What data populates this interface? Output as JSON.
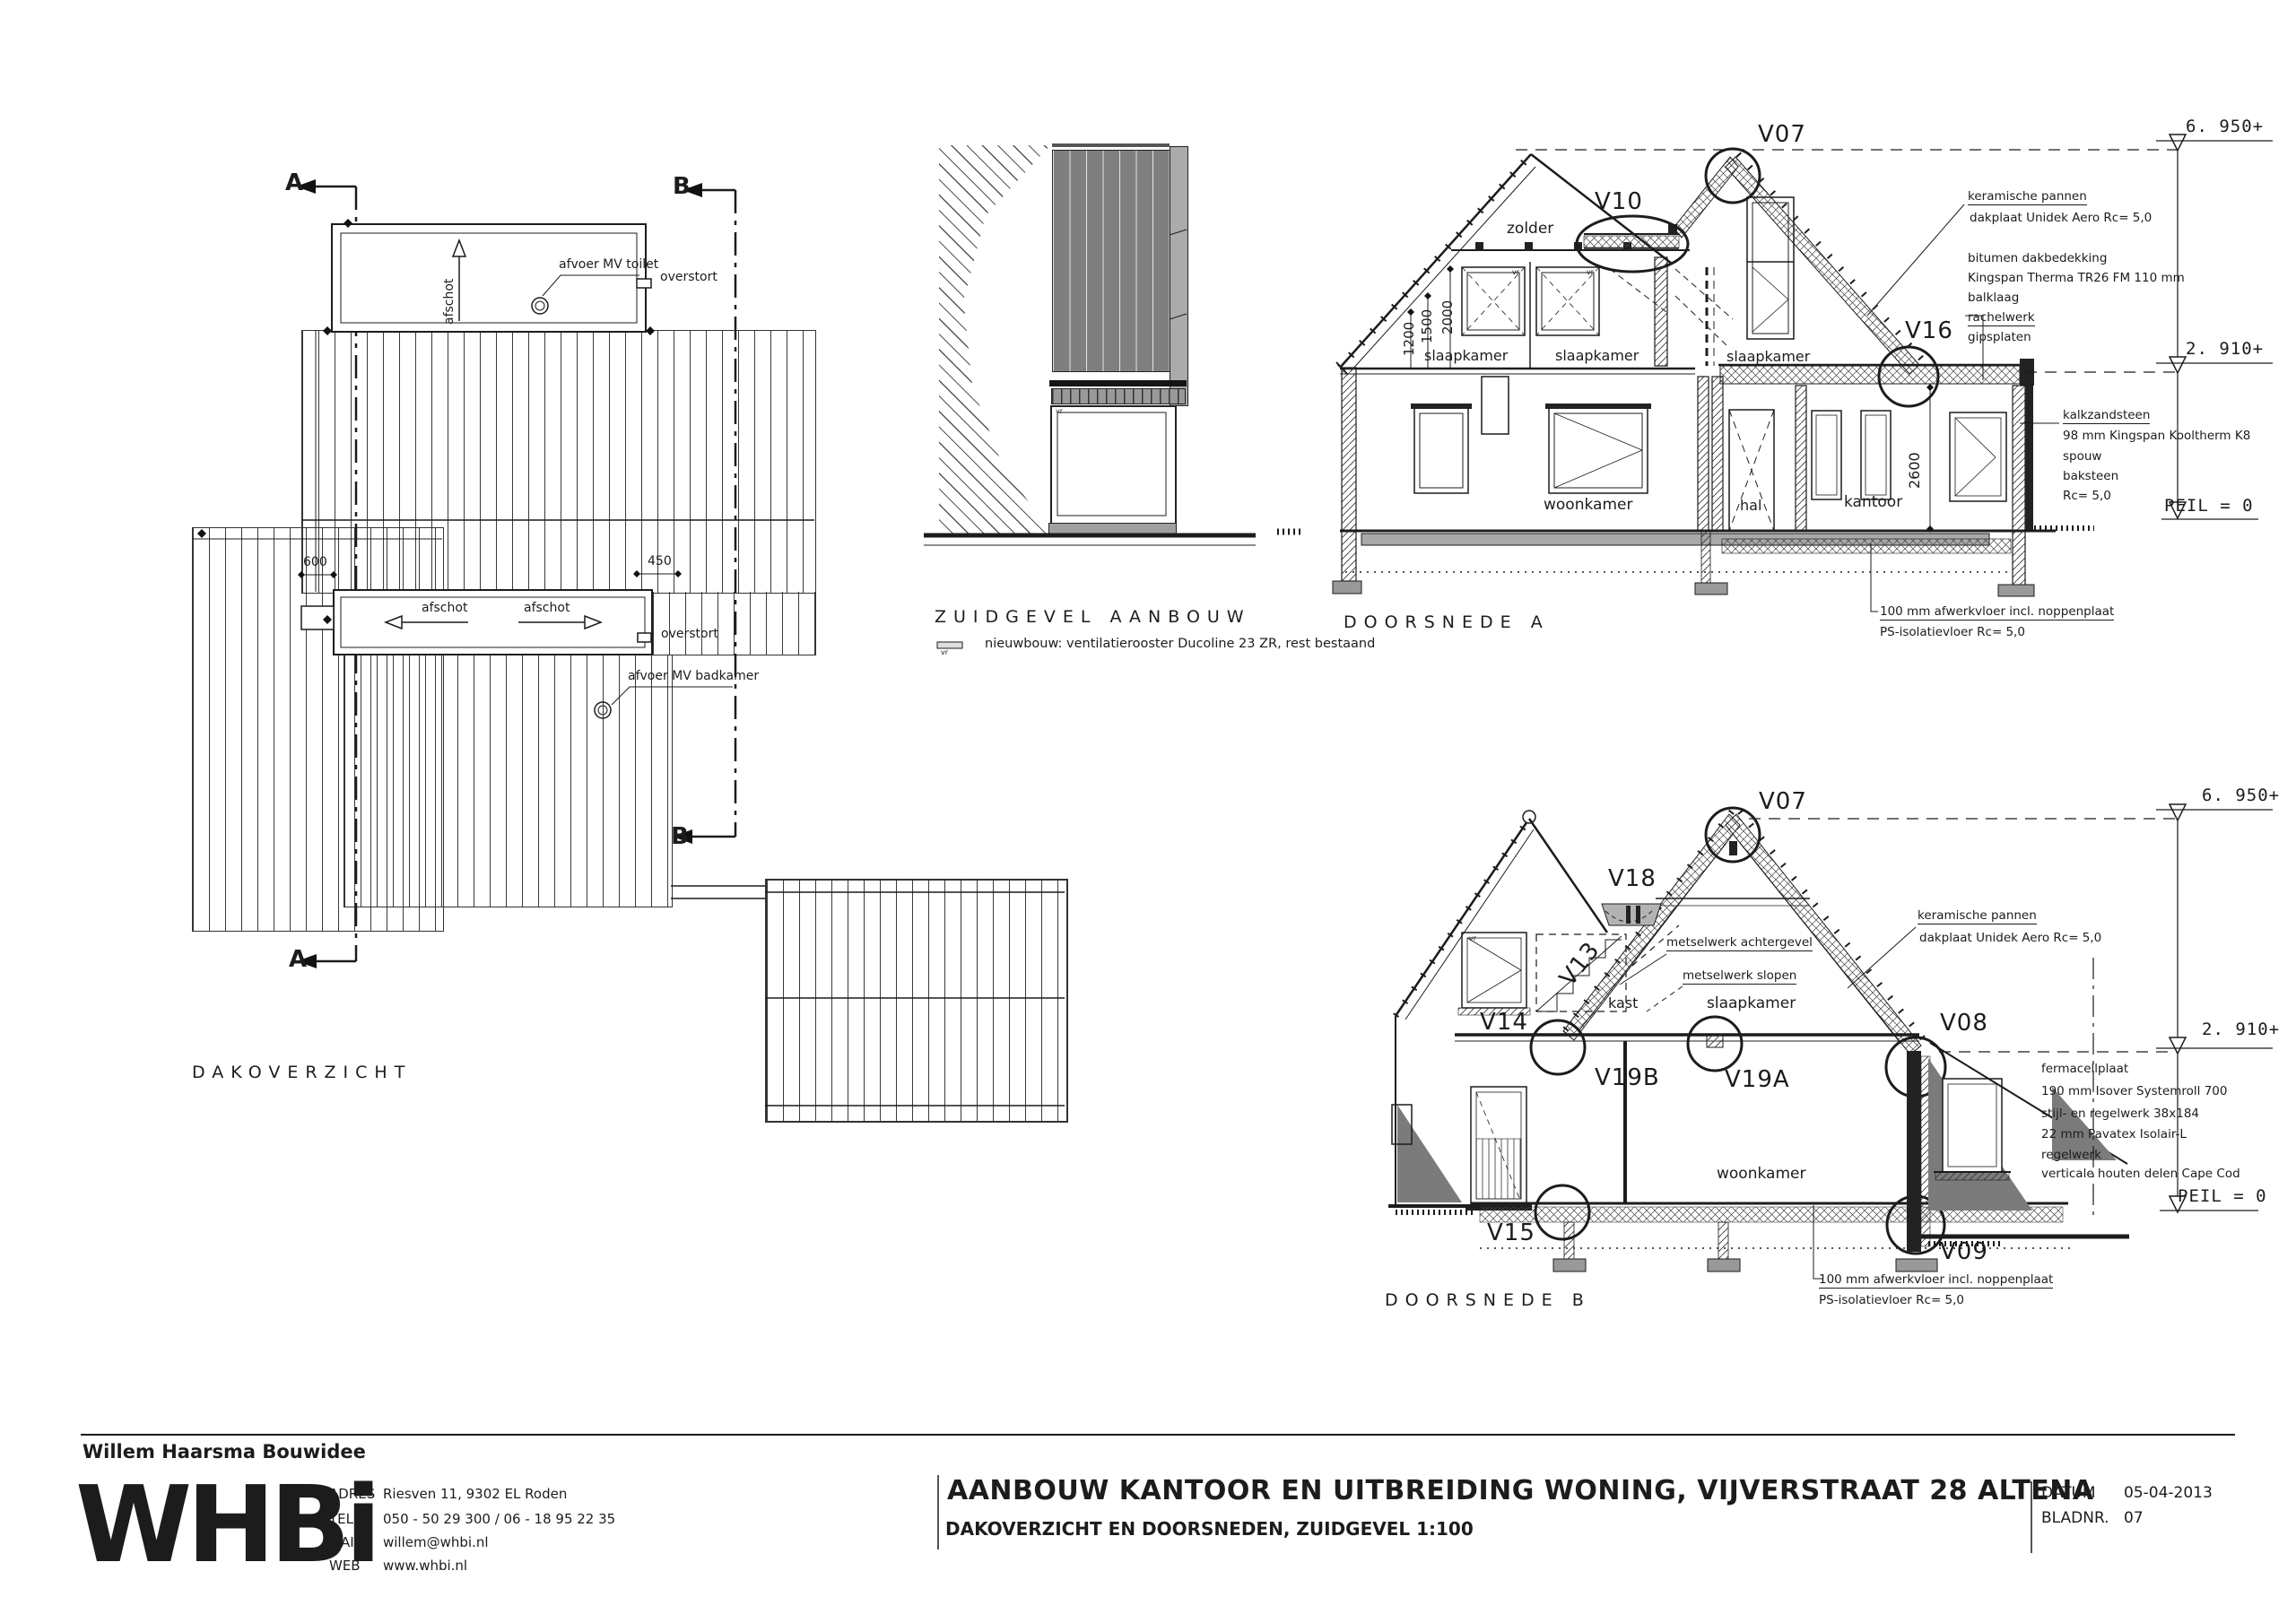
{
  "page": {
    "bg": "#ffffff",
    "line_color": "#1c1c1c",
    "shade_gray": "#7b7b7b",
    "slab_gray": "#a8a8a8"
  },
  "misc": {
    "vr": "vr"
  },
  "roofplan": {
    "title": "DAKOVERZICHT",
    "section_a": "A",
    "section_b": "B",
    "afschot": "afschot",
    "afvoer_mv_toilet": "afvoer MV toilet",
    "afvoer_mv_badkamer": "afvoer MV badkamer",
    "overstort": "overstort",
    "dim_600": "600",
    "dim_450": "450"
  },
  "zuidgevel": {
    "title": "ZUIDGEVEL AANBOUW",
    "note": "nieuwbouw: ventilatierooster Ducoline 23 ZR, rest bestaand"
  },
  "doorsnede_a": {
    "title": "DOORSNEDE A",
    "rooms": {
      "zolder": "zolder",
      "slaapkamer": "slaapkamer",
      "woonkamer": "woonkamer",
      "hal": "hal",
      "kantoor": "kantoor"
    },
    "tags": {
      "v07": "V07",
      "v10": "V10",
      "v16": "V16"
    },
    "dims": {
      "d1200": "1200",
      "d1500": "1500",
      "d2000": "2000",
      "d2600": "2600"
    },
    "levels": {
      "l6950": "6. 950+",
      "l2910": "2. 910+",
      "peil": "PEIL = 0"
    },
    "roof_notes": [
      "keramische pannen",
      "dakplaat Unidek Aero Rc= 5,0",
      "bitumen dakbedekking",
      "Kingspan Therma TR26 FM 110 mm",
      "balklaag",
      "rachelwerk",
      "gipsplaten"
    ],
    "wall_notes": [
      "kalkzandsteen",
      "98 mm Kingspan Kooltherm K8",
      "spouw",
      "baksteen",
      "Rc= 5,0"
    ],
    "floor_notes": [
      "100 mm afwerkvloer incl. noppenplaat",
      "PS-isolatievloer Rc= 5,0"
    ]
  },
  "doorsnede_b": {
    "title": "DOORSNEDE B",
    "rooms": {
      "kast": "kast",
      "slaapkamer": "slaapkamer",
      "woonkamer": "woonkamer"
    },
    "tags": {
      "v07": "V07",
      "v08": "V08",
      "v09": "V09",
      "v13": "V13",
      "v14": "V14",
      "v15": "V15",
      "v18": "V18",
      "v19a": "V19A",
      "v19b": "V19B"
    },
    "notes": {
      "achtergevel": "metselwerk achtergevel",
      "slopen": "metselwerk slopen"
    },
    "roof_notes": [
      "keramische pannen",
      "dakplaat Unidek Aero Rc= 5,0"
    ],
    "wall_notes": [
      "fermacellplaat",
      "190 mm Isover Systemroll 700",
      "stijl- en regelwerk 38x184",
      "22 mm Pavatex Isolair-L",
      "regelwerk",
      "verticale houten delen Cape Cod"
    ],
    "floor_notes": [
      "100 mm afwerkvloer incl. noppenplaat",
      "PS-isolatievloer Rc= 5,0"
    ],
    "levels": {
      "l6950": "6. 950+",
      "l2910": "2. 910+",
      "peil": "PEIL = 0"
    }
  },
  "titleblock": {
    "company": "Willem Haarsma Bouwidee",
    "logo": "WHBi",
    "contact": {
      "adres_label": "ADRES",
      "adres": "Riesven 11, 9302 EL Roden",
      "tel_label": "TEL",
      "tel": "050 - 50 29 300 / 06 - 18 95 22 35",
      "mail_label": "MAIL",
      "mail": "willem@whbi.nl",
      "web_label": "WEB",
      "web": "www.whbi.nl"
    },
    "project": "AANBOUW KANTOOR EN UITBREIDING WONING, VIJVERSTRAAT 28 ALTENA",
    "sheet": "DAKOVERZICHT EN DOORSNEDEN, ZUIDGEVEL  1:100",
    "datum_label": "DATUM",
    "datum": "05-04-2013",
    "bladnr_label": "BLADNR.",
    "bladnr": "07"
  }
}
